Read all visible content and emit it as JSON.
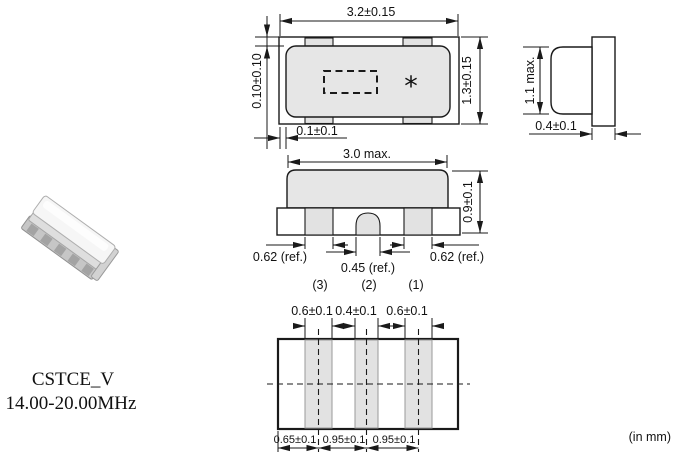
{
  "title": {
    "series": "CSTCE_V",
    "freq_range": "14.00-20.00MHz"
  },
  "units_note": "(in mm)",
  "colors": {
    "line": "#1a1a1a",
    "cap_fill": "#e6e6e6",
    "pad_fill": "#e2e2e2",
    "background": "#ffffff"
  },
  "top_view": {
    "overall_width": "3.2±0.15",
    "overall_height": "1.3±0.15",
    "cap_offset_top": "0.10±0.10",
    "cap_offset_left": "0.1±0.1",
    "marking_symbol": "*"
  },
  "side_view": {
    "max_height": "1.1 max.",
    "substrate_thickness": "0.4±0.1"
  },
  "front_view": {
    "cap_width": "3.0 max.",
    "overall_height": "0.9±0.1",
    "terminal_left": "0.62 (ref.)",
    "terminal_center": "0.45 (ref.)",
    "terminal_right": "0.62 (ref.)",
    "terminal_numbers": [
      "(3)",
      "(2)",
      "(1)"
    ]
  },
  "land_pattern": {
    "pad_widths": [
      "0.6±0.1",
      "0.4±0.1",
      "0.6±0.1"
    ],
    "pad_pitches": [
      "0.65±0.1",
      "0.95±0.1",
      "0.95±0.1"
    ]
  }
}
